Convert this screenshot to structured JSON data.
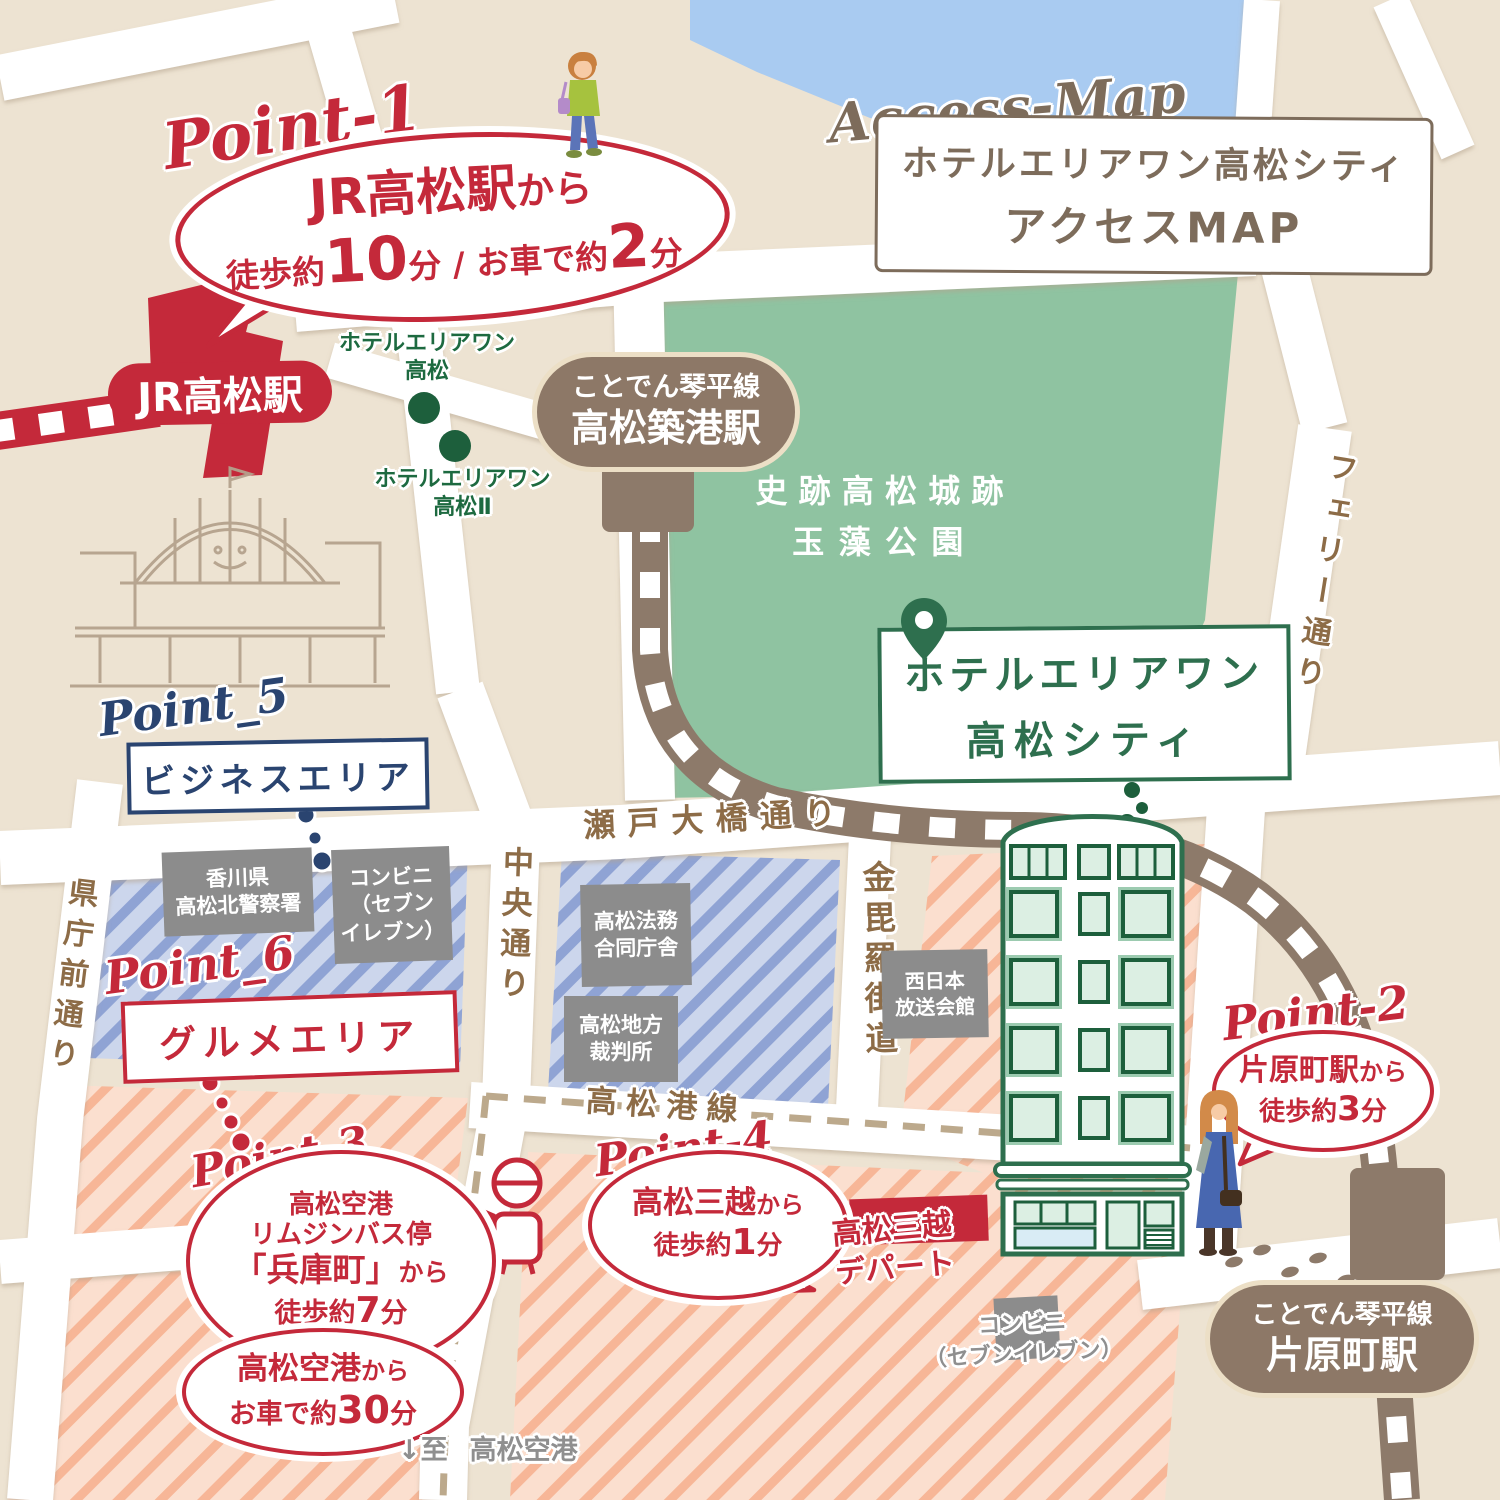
{
  "title": {
    "script": "Access-Map",
    "line1": "ホテルエリアワン高松シティ",
    "line2": "アクセスMAP"
  },
  "stations": {
    "jr_takamatsu": "JR高松駅",
    "chikko": {
      "line": "ことでん琴平線",
      "name": "高松築港駅"
    },
    "katahara": {
      "line": "ことでん琴平線",
      "name": "片原町駅"
    }
  },
  "park": {
    "line1": "史跡高松城跡",
    "line2": "玉藻公園"
  },
  "hotel": {
    "main": {
      "line1": "ホテルエリアワン",
      "line2": "高松シティ"
    },
    "sister1": {
      "line1": "ホテルエリアワン",
      "line2": "高松"
    },
    "sister2": {
      "line1": "ホテルエリアワン",
      "line2": "高松Ⅱ"
    }
  },
  "points": {
    "p1": {
      "script": "Point-1",
      "dest": "JR高松駅",
      "suffix": "から",
      "walk_pre": "徒歩約",
      "walk_num": "10",
      "walk_unit": "分",
      "sep": " / ",
      "car_pre": "お車で約",
      "car_num": "2",
      "car_unit": "分"
    },
    "p2": {
      "script": "Point-2",
      "dest": "片原町駅",
      "suffix": "から",
      "walk_pre": "徒歩約",
      "walk_num": "3",
      "walk_unit": "分"
    },
    "p3": {
      "script": "Point-3",
      "line1": "高松空港",
      "line2": "リムジンバス停",
      "dest": "「兵庫町」",
      "suffix": "から",
      "walk_pre": "徒歩約",
      "walk_num": "7",
      "walk_unit": "分"
    },
    "p3b": {
      "dest": "高松空港",
      "suffix": "から",
      "car_pre": "お車で約",
      "car_num": "30",
      "car_unit": "分"
    },
    "p4": {
      "script": "Point-4",
      "dest": "高松三越",
      "suffix": "から",
      "walk_pre": "徒歩約",
      "walk_num": "1",
      "walk_unit": "分"
    },
    "p5": {
      "script": "Point_5",
      "label": "ビジネスエリア"
    },
    "p6": {
      "script": "Point_6",
      "label": "グルメエリア"
    }
  },
  "streets": {
    "seto": "瀬戸大橋通り",
    "chuo": "中央通り",
    "konpira": "金毘羅街道",
    "kencho": "県庁前通り",
    "ferry": "フェリー通り",
    "minato": "高松港線"
  },
  "buildings": {
    "police": {
      "line1": "香川県",
      "line2": "高松北警察署"
    },
    "conbini_left": {
      "line1": "コンビニ",
      "line2": "（セブン",
      "line3": "イレブン）"
    },
    "homu": {
      "line1": "高松法務",
      "line2": "合同庁舎"
    },
    "court": {
      "line1": "高松地方",
      "line2": "裁判所"
    },
    "nishinippon": {
      "line1": "西日本",
      "line2": "放送会館"
    },
    "mitsukoshi": {
      "line1": "高松三越",
      "line2": "デパート"
    },
    "conbini_bottom": {
      "line1": "コンビニ",
      "line2": "（セブンイレブン）"
    }
  },
  "notes": {
    "airport": {
      "arrow": "↓至",
      "dest": "高松空港"
    }
  },
  "colors": {
    "red": "#c4293a",
    "green": "#2e6f4e",
    "navy": "#2a4470",
    "taupe": "#8d7867",
    "street_brown": "#8d6c47",
    "gray": "#8c8c8c",
    "water": "#a9cbf1",
    "park": "#8fc3a1",
    "beige": "#ede3d2"
  }
}
